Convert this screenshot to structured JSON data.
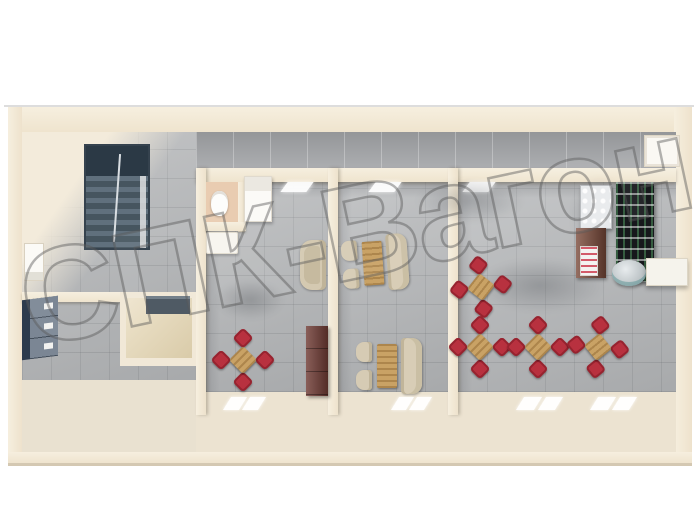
{
  "image_type": "3d-floorplan-render",
  "watermark": {
    "text": "СПК-Вагон",
    "outline_color": "#585858"
  },
  "palette": {
    "wall_cream": "#f1e8d7",
    "floor_tile_gray": "#b2b4b6",
    "corridor_tile_gray": "#a5a7aa",
    "hall_floor_cream": "#e9e1d0",
    "stairs_slate": "#3c4b58",
    "chair_red": "#b8313f",
    "table_wood": "#c9a265",
    "bench_beige": "#d6cbb4",
    "cabinet_dark_red": "#6f3b34",
    "locker_blue": "#2c3b4d",
    "wc_floor_salmon": "#e9ccb1",
    "utility_floor_tan": "#e5d6b2"
  },
  "rooms": [
    {
      "name": "stair-hall",
      "features": [
        "staircase",
        "west-door",
        "lockers",
        "utility-room-with-counter"
      ]
    },
    {
      "name": "room-1",
      "features": [
        "wc-cubicle-with-toilet",
        "fridge-cabinet",
        "sink-counter",
        "armchair",
        "red-dining-set",
        "dark-red-cabinet",
        "north-window",
        "south-window"
      ]
    },
    {
      "name": "room-2",
      "features": [
        "booth-dining-set",
        "booth-dining-set",
        "north-window",
        "south-window"
      ]
    },
    {
      "name": "room-3-dining-hall",
      "features": [
        "red-dining-set-x4",
        "wire-rack",
        "display-case",
        "maroon-product-shelf",
        "cooler-drum",
        "white-wall-shelf",
        "north-window",
        "south-windows-x2"
      ]
    },
    {
      "name": "north-corridor",
      "features": [
        "east-end-door"
      ]
    }
  ],
  "furniture": {
    "red_dining_sets": [
      {
        "x": 243,
        "y": 360,
        "rot": 45
      },
      {
        "x": 481,
        "y": 287,
        "rot": 38
      },
      {
        "x": 480,
        "y": 347,
        "rot": 45
      },
      {
        "x": 538,
        "y": 347,
        "rot": 45
      },
      {
        "x": 598,
        "y": 347,
        "rot": 51
      }
    ],
    "booth_sets": [
      {
        "x": 376,
        "y": 263,
        "rot": -4
      },
      {
        "x": 390,
        "y": 366,
        "rot": 0
      }
    ],
    "floor_shadows": [
      {
        "x": 470,
        "y": 200,
        "w": 110,
        "h": 45
      },
      {
        "x": 540,
        "y": 285,
        "w": 130,
        "h": 55
      },
      {
        "x": 600,
        "y": 215,
        "w": 60,
        "h": 80
      },
      {
        "x": 250,
        "y": 300,
        "w": 70,
        "h": 40
      }
    ]
  }
}
